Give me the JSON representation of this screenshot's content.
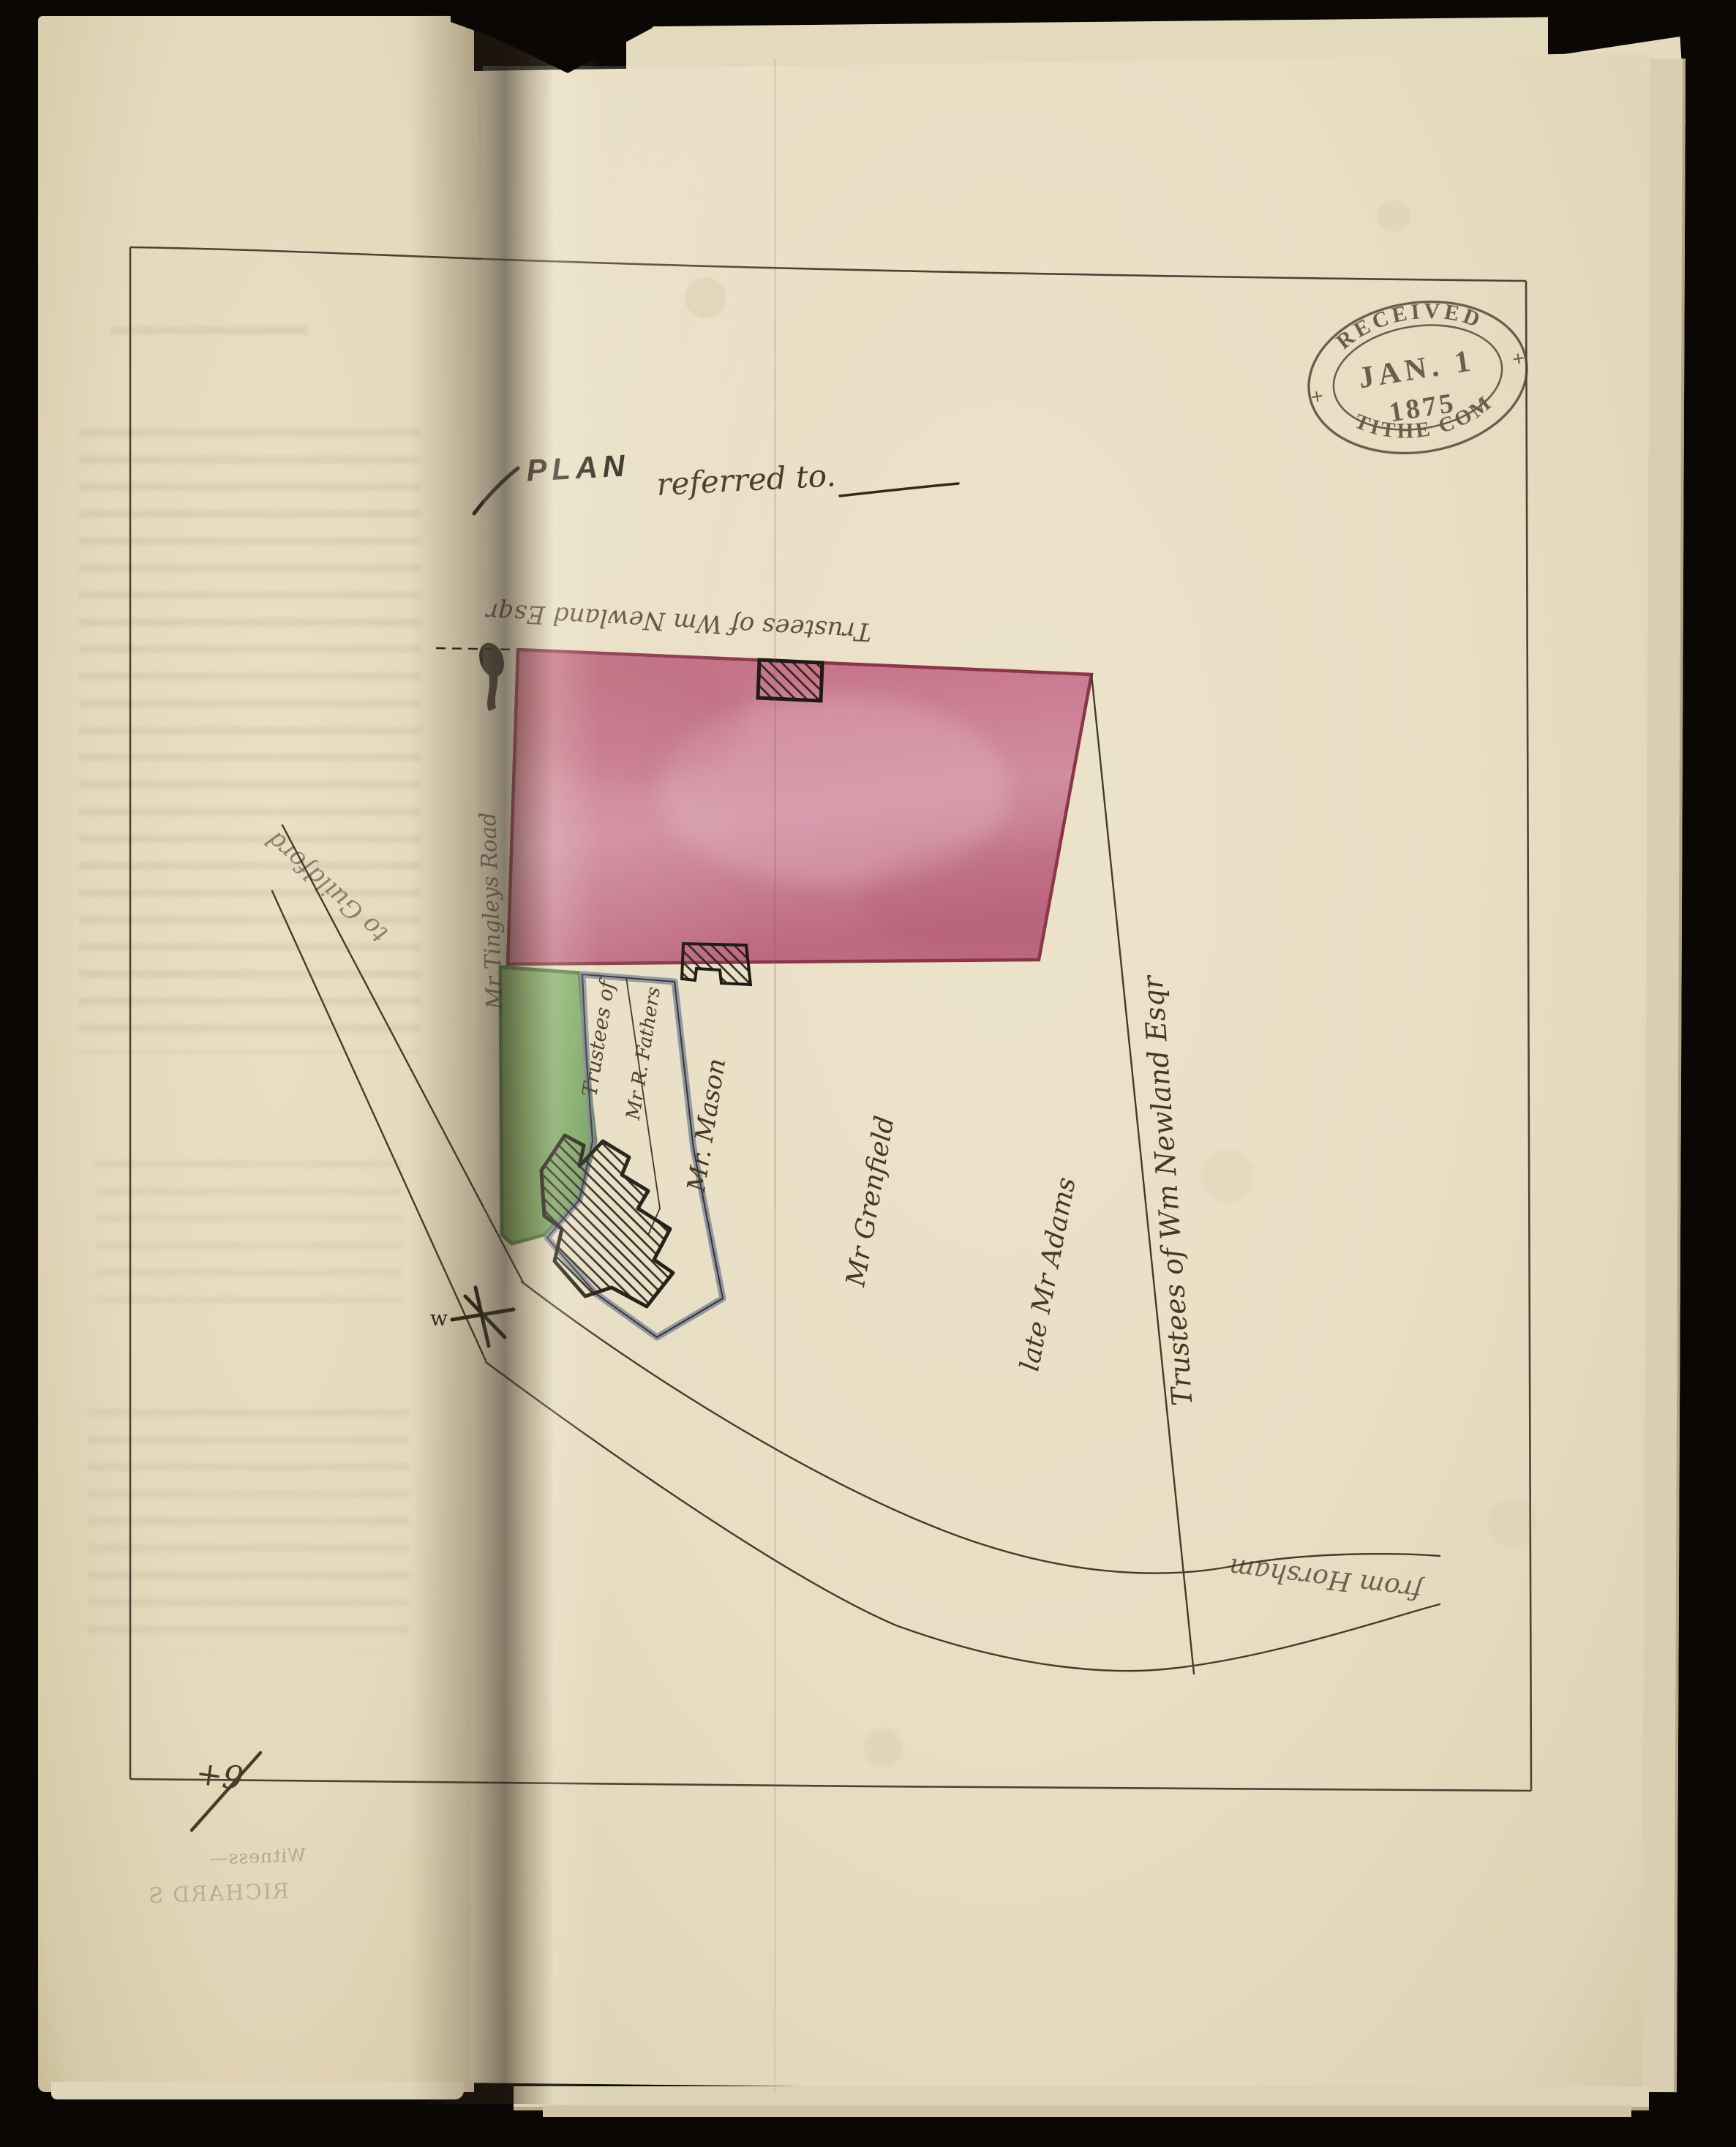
{
  "stamp": {
    "received": "RECEIVED",
    "date": "JAN. 1",
    "year": "1875",
    "office": "TITHE COM",
    "cross_left": "+",
    "cross_right": "+"
  },
  "title": {
    "plan": "PLAN",
    "referred": "referred to."
  },
  "parcels": {
    "newland_top": "Trustees of Wm Newland Esqr",
    "fathers_line1": "Trustees of",
    "fathers_line2": "Mr R. Fathers",
    "mason": "Mr. Mason",
    "grenfield": "Mr Grenfield",
    "adams": "late Mr Adams",
    "newland_right": "Trustees of Wm Newland Esqr"
  },
  "roads": {
    "to_guildford": "to Guildford",
    "from_horsham": "from Horsham",
    "gutter_road": "Mr Tingleys Road"
  },
  "marks": {
    "west": "w",
    "plus_nine": "+9"
  },
  "showthrough": {
    "witness": "Witness—",
    "name": "RICHARD S"
  },
  "colors": {
    "paper": "#e8dec4",
    "ink": "#3c3128",
    "handwriting": "#483624",
    "pink_wash": "#c3758a",
    "pink_border": "#8a3648",
    "green_wash": "#7fae68",
    "blue_grey_edging": "#75859a",
    "stamp_ink": "#4e4436",
    "background": "#0a0705"
  }
}
